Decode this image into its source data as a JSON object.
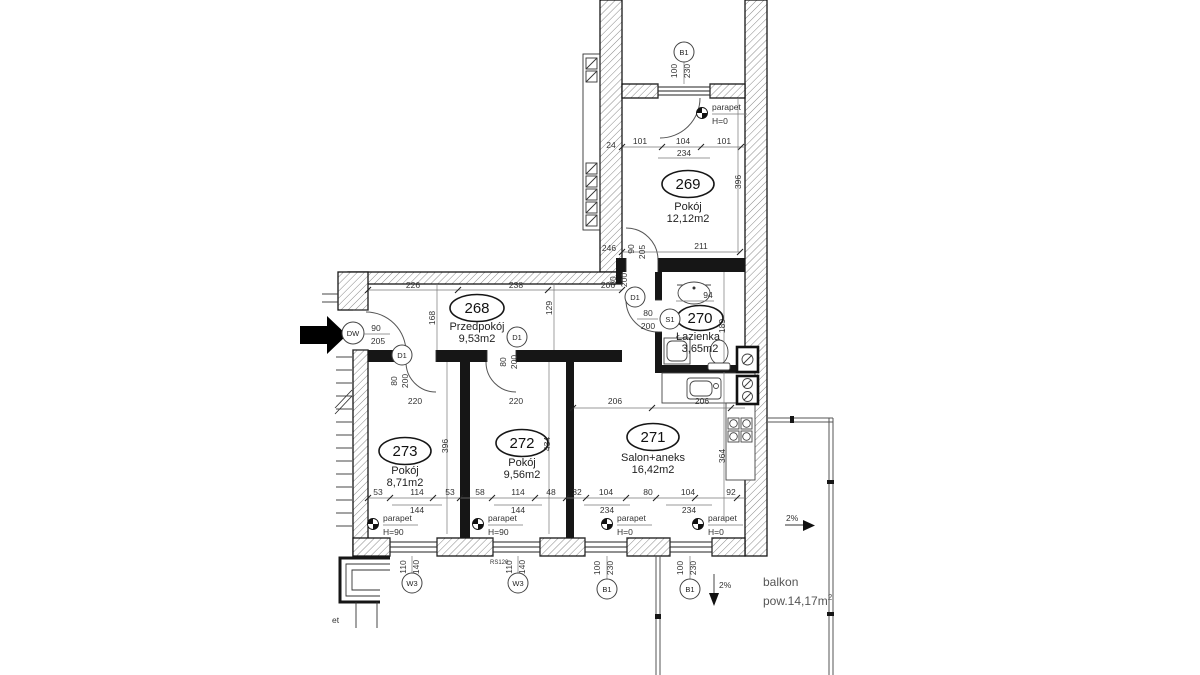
{
  "rooms": {
    "r268": {
      "no": "268",
      "name": "Przedpokój",
      "area": "9,53m2"
    },
    "r269": {
      "no": "269",
      "name": "Pokój",
      "area": "12,12m2"
    },
    "r270": {
      "no": "270",
      "name": "Łazienka",
      "area": "3,65m2"
    },
    "r271": {
      "no": "271",
      "name": "Salon+aneks",
      "area": "16,42m2"
    },
    "r272": {
      "no": "272",
      "name": "Pokój",
      "area": "9,56m2"
    },
    "r273": {
      "no": "273",
      "name": "Pokój",
      "area": "8,71m2"
    }
  },
  "balcony": {
    "name": "balkon",
    "area_prefix": "pow.14,17m",
    "area_sup": "2"
  },
  "openings": {
    "dw": {
      "code": "DW",
      "w": "90",
      "h": "205"
    },
    "d1": {
      "code": "D1",
      "w": "80",
      "h": "200"
    },
    "s1": {
      "code": "S1",
      "w": "80",
      "h": "200"
    },
    "w3": {
      "code": "W3",
      "w": "110",
      "h": "140"
    },
    "b1": {
      "code": "B1",
      "w": "100",
      "h": "230"
    },
    "door269": {
      "w": "90",
      "h": "205"
    },
    "rs": "RS120"
  },
  "dims": {
    "hall_top": [
      "226",
      "238",
      "206"
    ],
    "hall_depth": "168",
    "hall_depth2": "129",
    "r269_top": [
      "101",
      "104",
      "101"
    ],
    "r269_top_total": "234",
    "r269_width": "396",
    "r269_bottom": "211",
    "wall_24": "24",
    "wall_246": "246",
    "bath_sink": "94",
    "bath_depth": "189",
    "salon_top": [
      "206",
      "206"
    ],
    "salon_depth": "364",
    "salon_bottom": [
      "32",
      "104",
      "80",
      "104",
      "92"
    ],
    "salon_bottom_sub": [
      "234",
      "234"
    ],
    "r273_top": "220",
    "r273_depth": "396",
    "r273_bottom": [
      "53",
      "114",
      "53"
    ],
    "r273_bottom_sub": "144",
    "r272_top": "220",
    "r272_depth": "434",
    "r272_bottom": [
      "58",
      "114",
      "48"
    ],
    "r272_bottom_sub": "144"
  },
  "annotations": {
    "parapet": "parapet",
    "h0": "H=0",
    "h90": "H=90",
    "slope": "2%",
    "edge_fragment": "et"
  }
}
